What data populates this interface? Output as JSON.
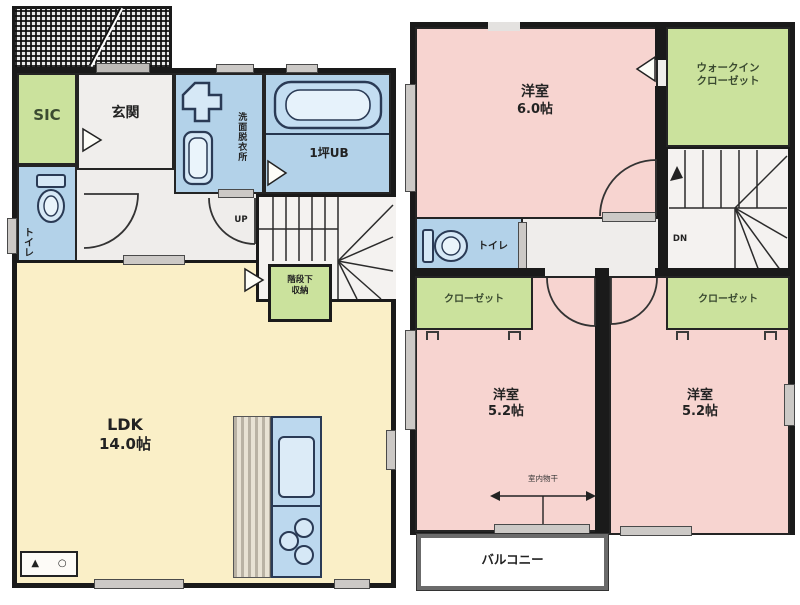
{
  "floor1": {
    "sic_label": "SIC",
    "genkan_label": "玄関",
    "washroom_label": "洗面脱衣所",
    "bath_label": "1坪UB",
    "toilet_label": "トイレ",
    "stairs_up_label": "UP",
    "storage_label_1": "階段下",
    "storage_label_2": "収納",
    "ldk_label": "LDK",
    "ldk_size": "14.0帖",
    "legend_symbols": {
      "triangle": "▲",
      "circle": "○"
    }
  },
  "floor2": {
    "bedroom1_label": "洋室",
    "bedroom1_size": "6.0帖",
    "wic_label_1": "ウォークイン",
    "wic_label_2": "クローゼット",
    "stairs_down_label": "DN",
    "toilet_label": "トイレ",
    "closet_left_label": "クローゼット",
    "closet_right_label": "クローゼット",
    "bedroom2_label": "洋室",
    "bedroom2_size": "5.2帖",
    "bedroom3_label": "洋室",
    "bedroom3_size": "5.2帖",
    "laundry_label": "室内物干",
    "balcony_label": "バルコニー"
  },
  "colors": {
    "wall": "#1a1a1a",
    "room_pink": "#f7d4d0",
    "room_green": "#cbe29d",
    "room_blue": "#b3d2e9",
    "room_yellow": "#faefc7",
    "room_gray": "#efedeb",
    "fixture_stroke": "#2a3a55",
    "window_fill": "#ccc9c6"
  }
}
